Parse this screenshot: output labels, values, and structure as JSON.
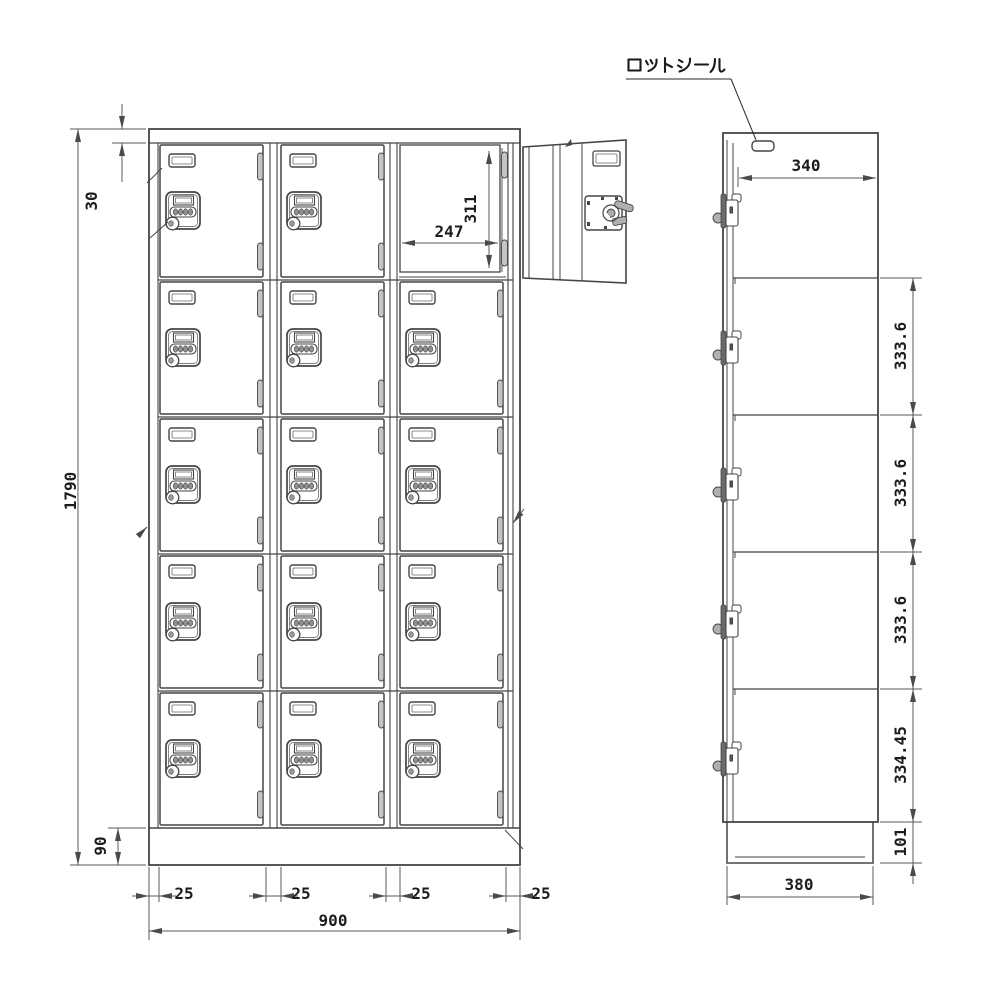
{
  "annotations": {
    "lot_seal_label": "ロットシール"
  },
  "dimensions": {
    "front": {
      "overall_height": "1790",
      "top_frame_height": "30",
      "base_height": "90",
      "overall_width": "900",
      "column_gaps": [
        "25",
        "25",
        "25",
        "25"
      ],
      "opening_width": "247",
      "opening_height": "311"
    },
    "side": {
      "top_depth": "340",
      "section_heights": [
        "333.6",
        "333.6",
        "333.6",
        "334.45"
      ],
      "base_height": "101",
      "bottom_depth": "380"
    }
  },
  "drawing": {
    "views": {
      "front": "front view - 3 columns x 5 rows coin lockers",
      "side": "side view"
    },
    "colors": {
      "line": "#454545",
      "dim_line": "#5a5a5a",
      "text": "#1d1d1d",
      "hinge_fill": "#c4c4c4",
      "dial_fill": "#909090",
      "latch_fill": "#6a6a6a"
    }
  }
}
